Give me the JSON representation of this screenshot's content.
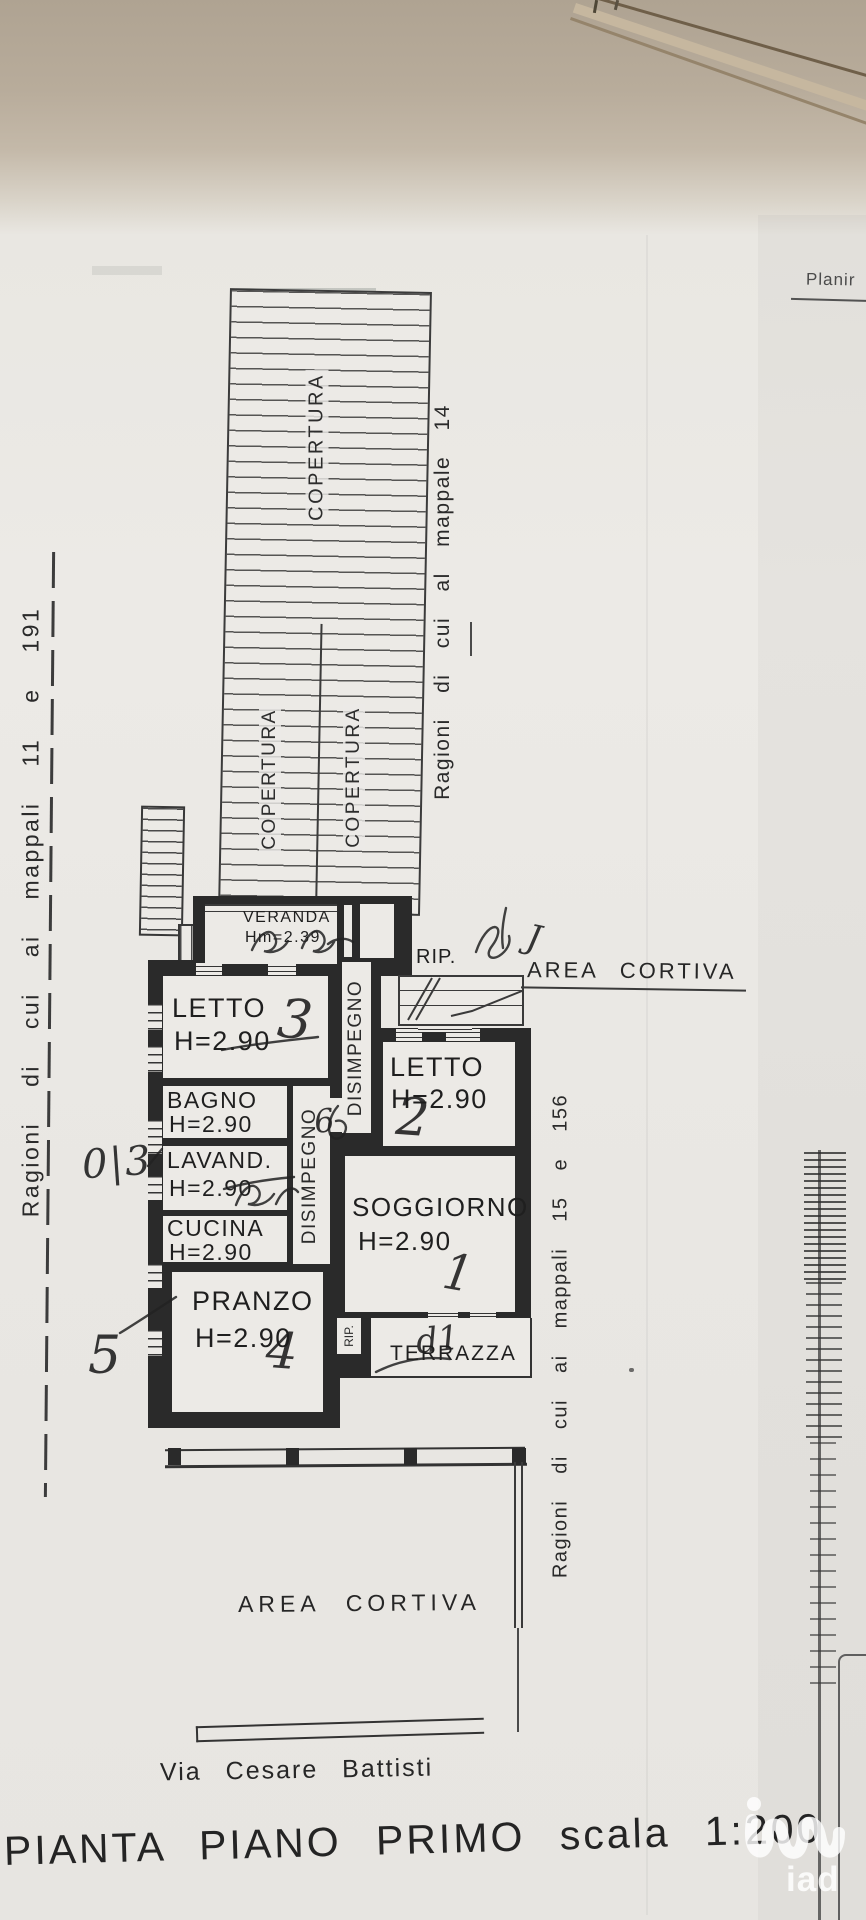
{
  "photo": {
    "corner_label": "Planir",
    "watermark_text": "iad"
  },
  "titles": {
    "plan_title": "PIANTA PIANO PRIMO scala 1:200",
    "street": "Via Cesare Battisti"
  },
  "boundaries": {
    "left": "Ragioni di cui ai mappali 11 e 191",
    "right_top": "Ragioni di cui al mappale 14",
    "right_bottom": "Ragioni di cui ai mappali 15 e 156"
  },
  "areas": {
    "cortiva_top": "AREA CORTIVA",
    "cortiva_bottom": "AREA CORTIVA",
    "rip_outside": "RIP."
  },
  "roof": {
    "label1": "COPERTURA",
    "label2": "COPERTURA",
    "label3": "COPERTURA"
  },
  "rooms": {
    "veranda": {
      "label": "VERANDA",
      "height": "Hm=2.39"
    },
    "letto3": {
      "label": "LETTO",
      "height": "H=2.90"
    },
    "letto2": {
      "label": "LETTO",
      "height": "H=2.90"
    },
    "bagno": {
      "label": "BAGNO",
      "height": "H=2.90"
    },
    "lavanderia": {
      "label": "LAVAND.",
      "height": "H=2.90"
    },
    "cucina": {
      "label": "CUCINA",
      "height": "H=2.90"
    },
    "soggiorno": {
      "label": "SOGGIORNO",
      "height": "H=2.90"
    },
    "pranzo": {
      "label": "PRANZO",
      "height": "H=2.90"
    },
    "disimpegno_left": {
      "label": "DISIMPEGNO"
    },
    "disimpegno_right": {
      "label": "DISIMPEGNO"
    },
    "rip_interno": {
      "label": "RIP."
    },
    "terrazza": {
      "label": "TERRAZZA"
    }
  },
  "annotations": {
    "letto3": "3",
    "letto2": "2",
    "soggiorno": "1",
    "pranzo": "4",
    "margin_note": "0|3",
    "margin_lower": "5",
    "near_rip": "J",
    "junction": "6",
    "terrazza_note": "d1"
  }
}
